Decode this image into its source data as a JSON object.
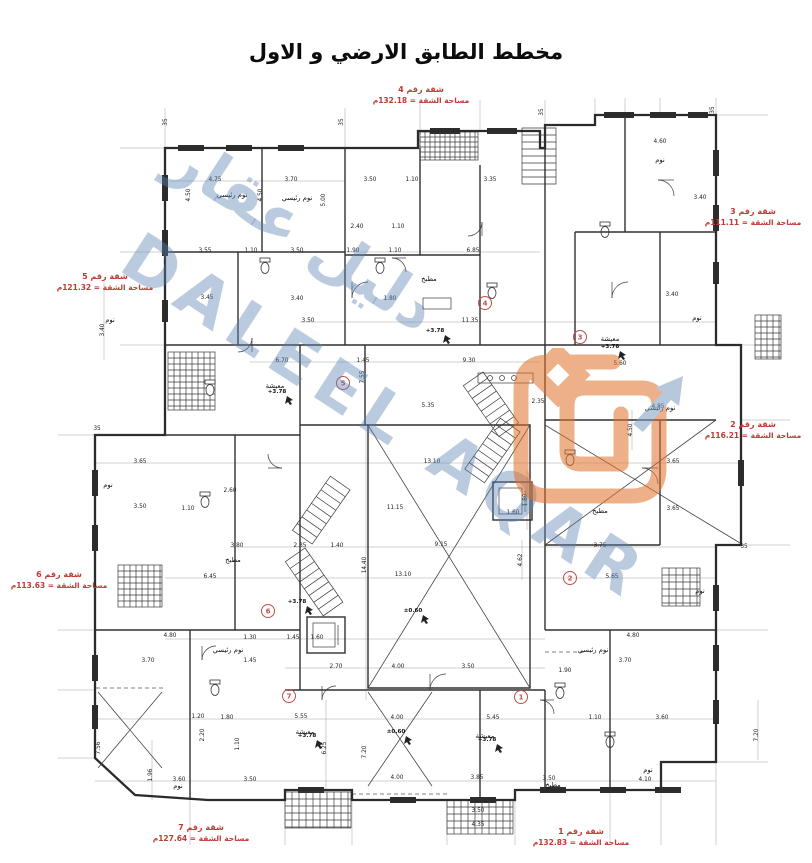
{
  "title": "مخطط الطابق الارضي و الاول",
  "watermark": {
    "arabic": "دليل عقار",
    "latin": "DALEEL AQAR",
    "color": "#5e82b2"
  },
  "logo": {
    "name": "daleel-aqar-logo",
    "orange": "#e0702a",
    "blue": "#7d9cc0"
  },
  "apartments": [
    {
      "name": "شقة رقم 4",
      "area": "مساحة الشقة = 132.18م"
    },
    {
      "name": "شقة رقم 3",
      "area": "مساحة الشقة = 111.11م"
    },
    {
      "name": "شقة رقم 5",
      "area": "مساحة الشقة = 121.32م"
    },
    {
      "name": "شقة رقم 2",
      "area": "مساحة الشقة = 116.21م"
    },
    {
      "name": "شقة رقم 6",
      "area": "مساحة الشقة = 113.63م"
    },
    {
      "name": "شقة رقم 7",
      "area": "مساحة الشقة = 127.64م"
    },
    {
      "name": "شقة رقم 1",
      "area": "مساحة الشقة = 132.83م"
    }
  ],
  "plan": {
    "room_labels": [
      "نوم رئيسي",
      "نوم",
      "مطبخ",
      "معيشة"
    ],
    "elevations": [
      "+3.78",
      "±0.60"
    ],
    "unit_markers": [
      "1",
      "2",
      "3",
      "4",
      "5",
      "6",
      "7"
    ],
    "dims": [
      "4.75",
      "3.70",
      "3.50",
      "1.10",
      "3.35",
      "4.60",
      "3.40",
      "2.40",
      "1.10",
      "3.55",
      "1.10",
      "3.50",
      "1.90",
      "1.10",
      "6.85",
      "3.45",
      "3.40",
      "1.80",
      "3.40",
      "11.35",
      "3.50",
      "6.70",
      "1.45",
      "9.30",
      "5.60",
      "2.35",
      "5.35",
      "4.85",
      "13.10",
      "3.65",
      "3.65",
      "3.50",
      "1.10",
      "2.60",
      "11.15",
      "3.65",
      "1.60",
      "2.35",
      "1.40",
      "9.15",
      "3.80",
      "3.75",
      "6.45",
      "5.65",
      "13.10",
      "1.30",
      "1.45",
      "1.60",
      "4.80",
      "4.80",
      "3.70",
      "1.45",
      "2.70",
      "4.00",
      "3.50",
      "3.70",
      "1.90",
      "1.20",
      "1.80",
      "5.55",
      "4.00",
      "5.45",
      "1.10",
      "3.60",
      "3.60",
      "3.50",
      "4.00",
      "3.85",
      "3.50",
      "4.10",
      "3.50",
      "4.35",
      "4.50",
      "4.50",
      "5.00",
      "7.55",
      "14.40",
      "4.62",
      "4.50",
      "1.80",
      "3.40",
      "7.56",
      "1.96",
      "2.20",
      "1.10",
      "7.20",
      "7.20",
      "6.25",
      "35",
      "35",
      "35",
      "35",
      "35",
      "35"
    ],
    "colors": {
      "label_red": "#bf3b34",
      "line": "#3a3a3a"
    }
  }
}
